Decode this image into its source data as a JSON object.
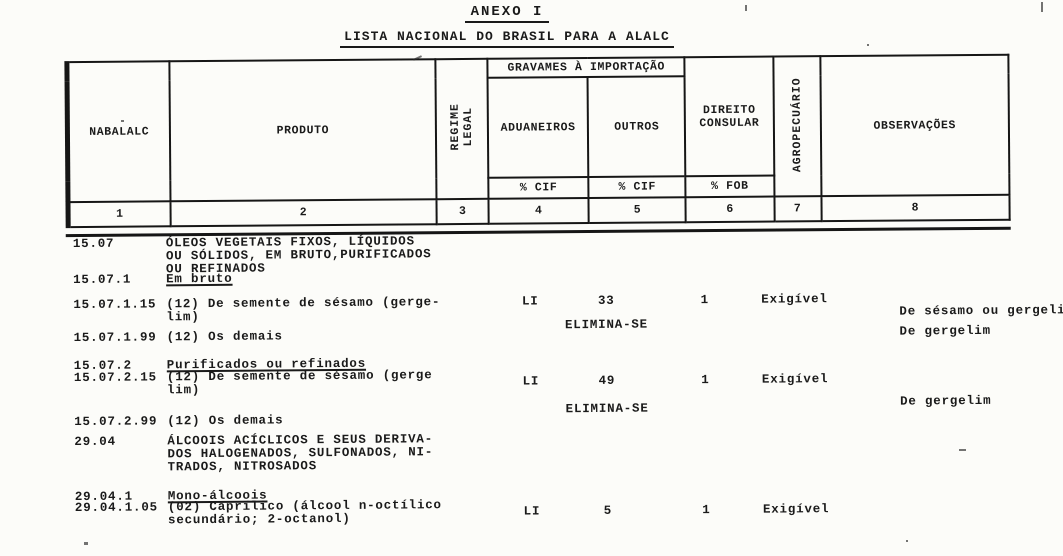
{
  "page": {
    "title": "ANEXO I",
    "subtitle": "LISTA NACIONAL DO BRASIL PARA A ALALC"
  },
  "table": {
    "header": {
      "nabalalc": "NABALALC",
      "produto": "PRODUTO",
      "regime_legal": "REGIME\nLEGAL",
      "gravames": "GRAVAMES À IMPORTAÇÃO",
      "aduaneiros": "ADUANEIROS",
      "outros": "OUTROS",
      "direito_consular": "DIREITO\nCONSULAR",
      "agropecuario": "AGROPECUÁRIO",
      "observacoes": "OBSERVAÇÕES",
      "aduaneiros_unit": "% CIF",
      "outros_unit": "% CIF",
      "direito_unit": "% FOB"
    },
    "col_numbers": [
      "1",
      "2",
      "3",
      "4",
      "5",
      "6",
      "7",
      "8"
    ],
    "rows": [
      {
        "code": "15.07",
        "produto": "ÓLEOS VEGETAIS FIXOS,  LÍQUIDOS\nOU SÓLIDOS, EM BRUTO,PURIFICADOS\nOU REFINADOS"
      },
      {
        "code": "15.07.1",
        "produto": "Em bruto"
      },
      {
        "code": "15.07.1.15",
        "produto": "(12) De semente de sésamo (gerge-\nlim)",
        "regime_legal": "LI",
        "aduaneiros": "33",
        "outros": "1",
        "direito_consular": "Exigível",
        "observacoes": "De sésamo ou gergelim"
      },
      {
        "code": "15.07.1.99",
        "produto": "(12) Os demais",
        "aduaneiros": "ELIMINA-SE",
        "observacoes": "De gergelim"
      },
      {
        "code": "15.07.2",
        "produto": "Purificados ou refinados"
      },
      {
        "code": "15.07.2.15",
        "produto": "(12) De semente de sésamo  (gerge\nlim)",
        "regime_legal": "LI",
        "aduaneiros": "49",
        "outros": "1",
        "direito_consular": "Exigível"
      },
      {
        "code": "15.07.2.99",
        "produto": "(12) Os demais",
        "aduaneiros": "ELIMINA-SE",
        "observacoes": "De gergelim"
      },
      {
        "code": "29.04",
        "produto": "ÁLCOOIS ACÍCLICOS E SEUS  DERIVA-\nDOS HALOGENADOS, SULFONADOS,  NI-\nTRADOS, NITROSADOS"
      },
      {
        "code": "29.04.1",
        "produto": "Mono-álcoois"
      },
      {
        "code": "29.04.1.05",
        "produto": "(02) Caprílico (álcool n-octílico\nsecundário; 2-octanol)",
        "regime_legal": "LI",
        "aduaneiros": "5",
        "outros": "1",
        "direito_consular": "Exigível"
      }
    ]
  },
  "colors": {
    "ink": "#1a1a1a",
    "paper": "#fcfcf9"
  }
}
